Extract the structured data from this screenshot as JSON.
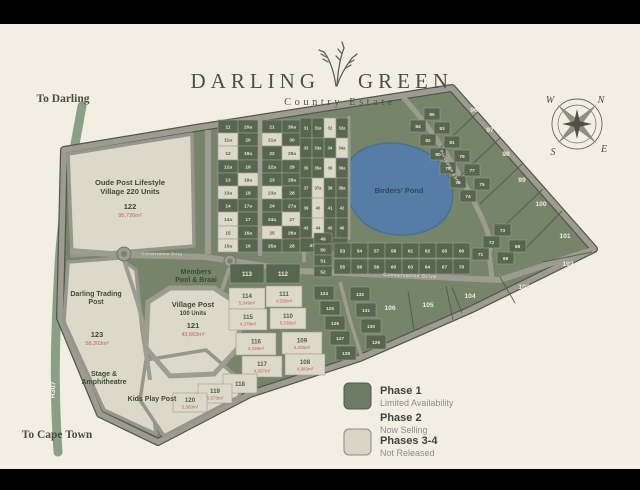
{
  "frame": {
    "bar_color": "#000000",
    "bg": "#f2efe2"
  },
  "title": {
    "word1": "DARLING",
    "word2": "GREEN",
    "subtitle": "Country Estate"
  },
  "offmap": {
    "to_darling": "To Darling",
    "to_cape_town": "To Cape Town",
    "r307_upper": "R307",
    "r307_lower": "R307"
  },
  "compass": {
    "n": "N",
    "e": "E",
    "s": "S",
    "w": "W"
  },
  "roads": {
    "conservation_west": "Conservation Drive",
    "conservation_main": "Conservation Drive",
    "porcupine": "Porcupine Lane"
  },
  "landmarks": {
    "oude": {
      "l1": "Oude Post Lifestyle",
      "l2": "Village 220 Units",
      "num": "122",
      "area": "95,720m²"
    },
    "village": {
      "l1": "Village Post",
      "l2": "100 Units",
      "num": "121",
      "area": "43,663m²"
    },
    "trading": {
      "l1": "Darling Trading",
      "l2": "Post",
      "num": "123",
      "area": "58,303m²"
    },
    "members": {
      "l1": "Members",
      "l2": "Pool & Braai"
    },
    "stage": {
      "l1": "Stage &",
      "l2": "Amphitheatre"
    },
    "kids": "Kids Play Post",
    "pond": "Birders' Pond"
  },
  "legend": {
    "items": [
      {
        "label": "Phase 1",
        "sub": "Limited Availability",
        "swatch": "#6d7a66"
      },
      {
        "label": "Phase 2",
        "sub": "Now Selling",
        "swatch": null
      },
      {
        "label": "Phases 3-4",
        "sub": "Not Released",
        "swatch": "#d8d5c7"
      }
    ]
  },
  "colors": {
    "phase1_fill": "#57664e",
    "phase1_text": "#ece7d4",
    "phase34_fill": "#dcd9ca",
    "phase34_text": "#51603f",
    "area_text": "#c4604e",
    "label_text": "#eeeadb",
    "ground": "#76846a",
    "road": "#9d9c91",
    "pond": "#567da6"
  },
  "map": {
    "plots": [
      [
        "11",
        218,
        120,
        20,
        13,
        "p1"
      ],
      [
        "11a",
        218,
        133,
        20,
        13,
        "p34"
      ],
      [
        "12",
        218,
        146,
        20,
        14,
        "p34"
      ],
      [
        "12a",
        218,
        160,
        20,
        13,
        "p1"
      ],
      [
        "13",
        218,
        173,
        20,
        13,
        "p1"
      ],
      [
        "13a",
        218,
        186,
        20,
        13,
        "p34"
      ],
      [
        "14",
        218,
        199,
        20,
        13,
        "p1"
      ],
      [
        "14a",
        218,
        212,
        20,
        14,
        "p34"
      ],
      [
        "15",
        218,
        226,
        20,
        13,
        "p34"
      ],
      [
        "15a",
        218,
        239,
        20,
        13,
        "p34"
      ],
      [
        "20a",
        238,
        120,
        20,
        13,
        "p1"
      ],
      [
        "20",
        238,
        133,
        20,
        13,
        "p1"
      ],
      [
        "19a",
        238,
        146,
        20,
        14,
        "p1"
      ],
      [
        "19",
        238,
        160,
        20,
        13,
        "p1"
      ],
      [
        "18a",
        238,
        173,
        20,
        13,
        "p34"
      ],
      [
        "18",
        238,
        186,
        20,
        13,
        "p1"
      ],
      [
        "17a",
        238,
        199,
        20,
        13,
        "p1"
      ],
      [
        "17",
        238,
        212,
        20,
        14,
        "p1"
      ],
      [
        "16a",
        238,
        226,
        20,
        13,
        "p1"
      ],
      [
        "16",
        238,
        239,
        20,
        13,
        "p1"
      ],
      [
        "21",
        262,
        120,
        20,
        13,
        "p1"
      ],
      [
        "21a",
        262,
        133,
        20,
        13,
        "p34"
      ],
      [
        "22",
        262,
        146,
        20,
        14,
        "p1"
      ],
      [
        "22a",
        262,
        160,
        20,
        13,
        "p1"
      ],
      [
        "23",
        262,
        173,
        20,
        13,
        "p1"
      ],
      [
        "23a",
        262,
        186,
        20,
        13,
        "p34"
      ],
      [
        "24",
        262,
        199,
        20,
        13,
        "p1"
      ],
      [
        "24a",
        262,
        212,
        20,
        14,
        "p1"
      ],
      [
        "25",
        262,
        226,
        20,
        13,
        "p34"
      ],
      [
        "25a",
        262,
        239,
        20,
        13,
        "p1"
      ],
      [
        "30a",
        282,
        120,
        20,
        13,
        "p1"
      ],
      [
        "30",
        282,
        133,
        20,
        13,
        "p1"
      ],
      [
        "29a",
        282,
        146,
        20,
        14,
        "p34"
      ],
      [
        "29",
        282,
        160,
        20,
        13,
        "p1"
      ],
      [
        "28a",
        282,
        173,
        20,
        13,
        "p1"
      ],
      [
        "28",
        282,
        186,
        20,
        13,
        "p1"
      ],
      [
        "27a",
        282,
        199,
        20,
        13,
        "p1"
      ],
      [
        "27",
        282,
        212,
        20,
        14,
        "p34"
      ],
      [
        "26a",
        282,
        226,
        20,
        13,
        "p1"
      ],
      [
        "26",
        282,
        239,
        20,
        13,
        "p1"
      ],
      [
        "31",
        300,
        118,
        12,
        20,
        "p1"
      ],
      [
        "31a",
        312,
        118,
        12,
        20,
        "p1"
      ],
      [
        "32",
        324,
        118,
        12,
        20,
        "p34"
      ],
      [
        "32a",
        336,
        118,
        12,
        20,
        "p1"
      ],
      [
        "33",
        300,
        138,
        12,
        20,
        "p1"
      ],
      [
        "33a",
        312,
        138,
        12,
        20,
        "p1"
      ],
      [
        "34",
        324,
        138,
        12,
        20,
        "p1"
      ],
      [
        "34a",
        336,
        138,
        12,
        20,
        "p34"
      ],
      [
        "35",
        300,
        158,
        12,
        20,
        "p1"
      ],
      [
        "35a",
        312,
        158,
        12,
        20,
        "p1"
      ],
      [
        "36",
        324,
        158,
        12,
        20,
        "p34"
      ],
      [
        "36a",
        336,
        158,
        12,
        20,
        "p1"
      ],
      [
        "37",
        300,
        178,
        12,
        20,
        "p1"
      ],
      [
        "37a",
        312,
        178,
        12,
        20,
        "p34"
      ],
      [
        "38",
        324,
        178,
        12,
        20,
        "p1"
      ],
      [
        "38a",
        336,
        178,
        12,
        20,
        "p1"
      ],
      [
        "39",
        300,
        198,
        12,
        20,
        "p1"
      ],
      [
        "40",
        312,
        198,
        12,
        20,
        "p34"
      ],
      [
        "41",
        324,
        198,
        12,
        20,
        "p1"
      ],
      [
        "42",
        336,
        198,
        12,
        20,
        "p1"
      ],
      [
        "43",
        300,
        218,
        12,
        20,
        "p1"
      ],
      [
        "44",
        312,
        218,
        12,
        20,
        "p34"
      ],
      [
        "45",
        324,
        218,
        12,
        20,
        "p1"
      ],
      [
        "46",
        336,
        218,
        12,
        20,
        "p1"
      ],
      [
        "47",
        300,
        238,
        24,
        14,
        "p1"
      ],
      [
        "48",
        324,
        238,
        24,
        14,
        "p1"
      ],
      [
        "49",
        314,
        233,
        18,
        11,
        "p1"
      ],
      [
        "50",
        314,
        244,
        18,
        11,
        "p1"
      ],
      [
        "51",
        314,
        255,
        18,
        11,
        "p1"
      ],
      [
        "52",
        314,
        266,
        18,
        11,
        "p1"
      ],
      [
        "53",
        334,
        243,
        17,
        15,
        "p1"
      ],
      [
        "54",
        351,
        243,
        17,
        15,
        "p1"
      ],
      [
        "57",
        368,
        243,
        17,
        15,
        "p1"
      ],
      [
        "58",
        385,
        243,
        17,
        15,
        "p1"
      ],
      [
        "61",
        402,
        243,
        17,
        15,
        "p1"
      ],
      [
        "62",
        419,
        243,
        17,
        15,
        "p1"
      ],
      [
        "65",
        436,
        243,
        17,
        15,
        "p1"
      ],
      [
        "66",
        453,
        243,
        17,
        15,
        "p1"
      ],
      [
        "55",
        334,
        259,
        17,
        15,
        "p1"
      ],
      [
        "56",
        351,
        259,
        17,
        15,
        "p1"
      ],
      [
        "59",
        368,
        259,
        17,
        15,
        "p1"
      ],
      [
        "60",
        385,
        259,
        17,
        15,
        "p1"
      ],
      [
        "63",
        402,
        259,
        17,
        15,
        "p1"
      ],
      [
        "64",
        419,
        259,
        17,
        15,
        "p1"
      ],
      [
        "67",
        436,
        259,
        17,
        15,
        "p1"
      ],
      [
        "70",
        453,
        259,
        17,
        15,
        "p1"
      ],
      [
        "85",
        424,
        108,
        16,
        12,
        "p1"
      ],
      [
        "84",
        410,
        120,
        16,
        12,
        "p1"
      ],
      [
        "83",
        434,
        122,
        16,
        12,
        "p1"
      ],
      [
        "82",
        420,
        134,
        16,
        12,
        "p1"
      ],
      [
        "81",
        444,
        136,
        16,
        12,
        "p1"
      ],
      [
        "80",
        430,
        148,
        16,
        12,
        "p1"
      ],
      [
        "79",
        454,
        150,
        16,
        12,
        "p1"
      ],
      [
        "78",
        440,
        162,
        16,
        12,
        "p1"
      ],
      [
        "77",
        464,
        164,
        16,
        12,
        "p1"
      ],
      [
        "76",
        450,
        176,
        16,
        12,
        "p1"
      ],
      [
        "75",
        474,
        178,
        16,
        12,
        "p1"
      ],
      [
        "74",
        460,
        190,
        16,
        12,
        "p1"
      ],
      [
        "73",
        494,
        224,
        17,
        12,
        "p1"
      ],
      [
        "72",
        483,
        236,
        17,
        12,
        "p1"
      ],
      [
        "71",
        472,
        248,
        17,
        12,
        "p1"
      ],
      [
        "68",
        509,
        240,
        17,
        12,
        "p1"
      ],
      [
        "69",
        497,
        252,
        17,
        12,
        "p1"
      ],
      [
        "113",
        230,
        264,
        34,
        19,
        "p1"
      ],
      [
        "112",
        266,
        264,
        34,
        19,
        "p1"
      ],
      [
        "114",
        229,
        288,
        36,
        21,
        "p34"
      ],
      [
        "111",
        266,
        286,
        36,
        21,
        "p34"
      ],
      [
        "115",
        229,
        309,
        38,
        21,
        "p34"
      ],
      [
        "110",
        270,
        308,
        36,
        21,
        "p34"
      ],
      [
        "116",
        236,
        333,
        40,
        22,
        "p34"
      ],
      [
        "109",
        282,
        332,
        40,
        22,
        "p34"
      ],
      [
        "117",
        242,
        356,
        40,
        21,
        "p34"
      ],
      [
        "108",
        285,
        354,
        40,
        21,
        "p34"
      ],
      [
        "118",
        223,
        374,
        34,
        19,
        "p34"
      ],
      [
        "119",
        198,
        384,
        34,
        19,
        "p34"
      ],
      [
        "120",
        173,
        393,
        34,
        19,
        "p34"
      ],
      [
        "124",
        314,
        286,
        20,
        14,
        "p1"
      ],
      [
        "125",
        320,
        301,
        20,
        14,
        "p1"
      ],
      [
        "126",
        325,
        316,
        20,
        14,
        "p1"
      ],
      [
        "127",
        330,
        331,
        20,
        14,
        "p1"
      ],
      [
        "128",
        336,
        346,
        20,
        14,
        "p1"
      ],
      [
        "132",
        350,
        287,
        20,
        14,
        "p1"
      ],
      [
        "131",
        356,
        303,
        20,
        14,
        "p1"
      ],
      [
        "130",
        361,
        319,
        20,
        14,
        "p1"
      ],
      [
        "129",
        366,
        335,
        20,
        14,
        "p1"
      ],
      [
        "96",
        474,
        112,
        0,
        0,
        "lbl"
      ],
      [
        "97",
        490,
        132,
        0,
        0,
        "lbl"
      ],
      [
        "98",
        506,
        156,
        0,
        0,
        "lbl"
      ],
      [
        "99",
        522,
        182,
        0,
        0,
        "lbl"
      ],
      [
        "100",
        541,
        206,
        0,
        0,
        "lbl"
      ],
      [
        "101",
        565,
        238,
        0,
        0,
        "lbl"
      ],
      [
        "102",
        568,
        266,
        0,
        0,
        "lbl"
      ],
      [
        "103",
        524,
        289,
        0,
        0,
        "lbl"
      ],
      [
        "104",
        470,
        298,
        0,
        0,
        "lbl"
      ],
      [
        "105",
        428,
        307,
        0,
        0,
        "lbl"
      ],
      [
        "106",
        390,
        310,
        0,
        0,
        "lbl"
      ]
    ],
    "areas": {
      "114": "5,049m²",
      "111": "4,536m²",
      "115": "4,378m²",
      "110": "5,035m²",
      "116": "4,339m²",
      "109": "5,325m²",
      "117": "4,507m²",
      "108": "4,983m²",
      "119": "5,578m²",
      "120": "5,560m²"
    }
  }
}
